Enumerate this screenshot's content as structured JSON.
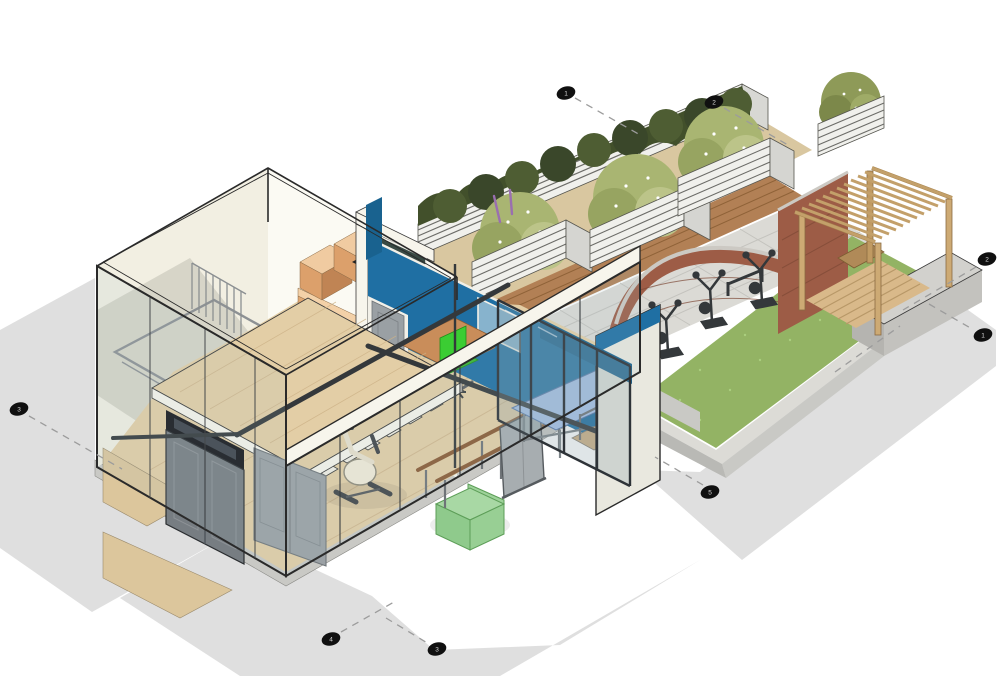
{
  "scene": {
    "kind": "axonometric-architectural-cutaway",
    "subject": "gym building with outdoor exercise garden"
  },
  "colors": {
    "background": "#ffffff",
    "shadow": "#d9d9d9",
    "wall_cream": "#f2efe2",
    "wall_white": "#fbfaf3",
    "fascia": "#f7f5ec",
    "blue": "#1f6fa3",
    "blue_band": "#19628f",
    "wood_floor": "#e3cea6",
    "wood_cabinet": "#e0a873",
    "wood_deck": "#b28055",
    "pergola_wood": "#cdaa74",
    "glass": "rgba(165,190,195,0.14)",
    "edge": "#2a2a2a",
    "steel": "#34383b",
    "door_dark": "#777d82",
    "door_light": "#9ba1a5",
    "rail": "#5b5f62",
    "lawn": "#93b364",
    "lawn_dot": "#aace7e",
    "hedge": "#42502b",
    "hedge_hi": "#4e5d33",
    "shrub": "#a9b572",
    "shrub_hi": "#bcc489",
    "flower_purple": "#9a6fb0",
    "brick": "#9d5c46",
    "coping": "#ccc9c3",
    "concrete": "#c9c9c5",
    "concrete_hi": "#dcdbd6",
    "paving": "#dbdad5",
    "gravel": "#d9c7a0",
    "planter_light": "#f0f0ec",
    "planter_stripe": "#6c6c68",
    "armchair_green": "#9ed29a",
    "table_blue": "#aac5ee",
    "chair_green": "#3bcd33",
    "marker": "#101010"
  },
  "grid": {
    "markers": [
      {
        "label": "1"
      },
      {
        "label": "2"
      },
      {
        "label": "2"
      },
      {
        "label": "1"
      },
      {
        "label": "5"
      },
      {
        "label": "3"
      },
      {
        "label": "4"
      },
      {
        "label": "3"
      }
    ]
  }
}
